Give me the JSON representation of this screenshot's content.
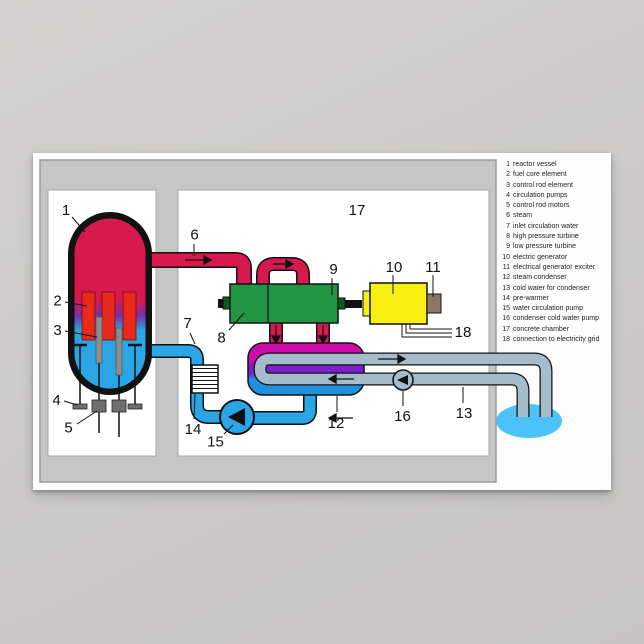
{
  "diagram": {
    "labels": [
      "1",
      "2",
      "3",
      "4",
      "5",
      "6",
      "7",
      "8",
      "9",
      "10",
      "11",
      "12",
      "13",
      "14",
      "15",
      "16",
      "17",
      "18"
    ]
  },
  "legend": {
    "items": [
      {
        "num": "1",
        "label": "reactor vessel"
      },
      {
        "num": "2",
        "label": "fuel core element"
      },
      {
        "num": "3",
        "label": "control rod element"
      },
      {
        "num": "4",
        "label": "circulation pumps"
      },
      {
        "num": "5",
        "label": "control rod motors"
      },
      {
        "num": "6",
        "label": "steam"
      },
      {
        "num": "7",
        "label": "inlet circulation water"
      },
      {
        "num": "8",
        "label": "high pressure turbine"
      },
      {
        "num": "9",
        "label": "low pressure turbine"
      },
      {
        "num": "10",
        "label": "electric generator"
      },
      {
        "num": "11",
        "label": "electrical generator exciter"
      },
      {
        "num": "12",
        "label": "steam condenser"
      },
      {
        "num": "13",
        "label": "cold water for condenser"
      },
      {
        "num": "14",
        "label": "pre-warmer"
      },
      {
        "num": "15",
        "label": "water circulation pump"
      },
      {
        "num": "16",
        "label": "condenser cold water pump"
      },
      {
        "num": "17",
        "label": "concrete chamber"
      },
      {
        "num": "18",
        "label": "connection to electricity grid"
      }
    ]
  },
  "colors": {
    "steam": "#d81950",
    "water": "#2aa5e5",
    "fuel_rod": "#e8291c",
    "control_rod": "#8d8d8d",
    "turbine": "#229544",
    "generator": "#f7ef12",
    "exciter": "#8d7663",
    "condenser_magenta": "#cc0ca8",
    "condenser_purple": "#7a1fc9",
    "cooling_pipe": "#a5bdcb",
    "pool": "#4cc2f8",
    "concrete": "#c6c6c6"
  }
}
